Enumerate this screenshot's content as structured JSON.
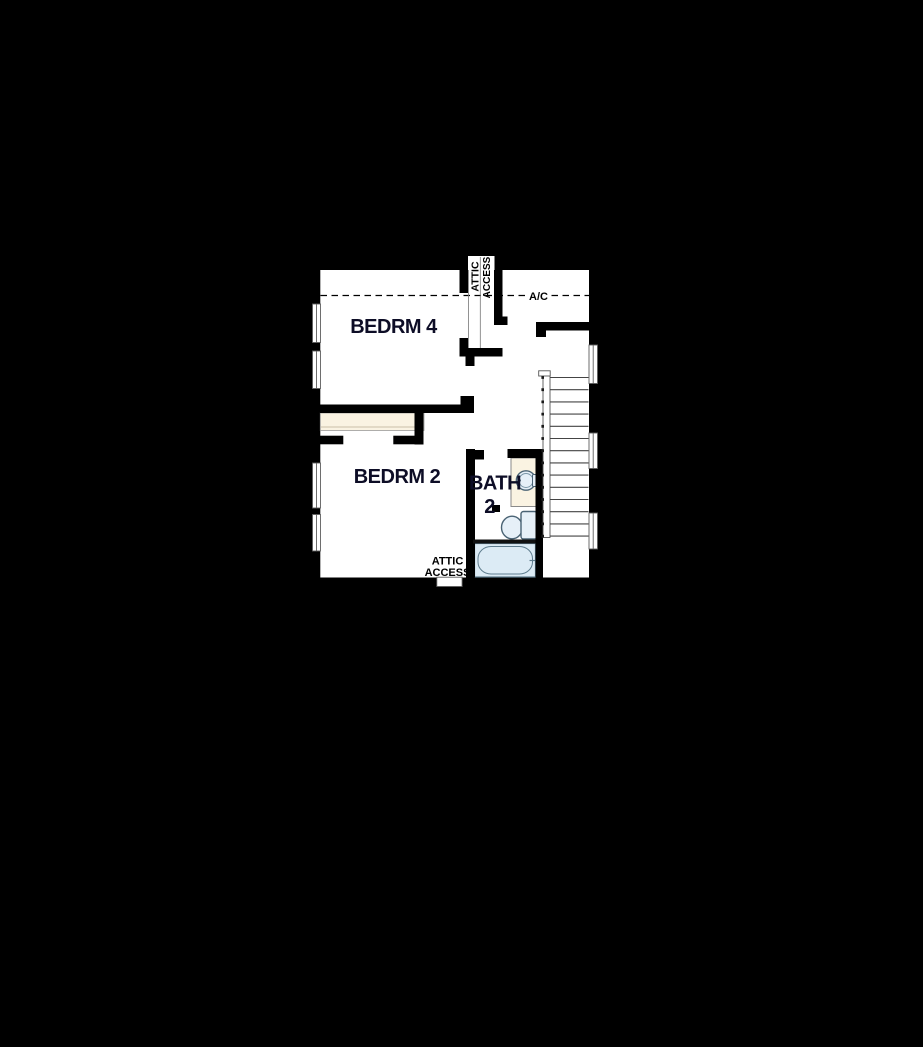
{
  "window": {
    "width": 923,
    "height": 1047,
    "background": "#000000"
  },
  "floor_plan": {
    "type": "residential-second-floor-plan",
    "rooms": {
      "bedroom4": {
        "label": "BEDRM 4"
      },
      "bedroom2": {
        "label": "BEDRM 2"
      },
      "bath2": {
        "label": "BATH",
        "number": "2"
      }
    },
    "annotations": {
      "ac": {
        "label": "A/C"
      },
      "attic_access_top": {
        "line1": "ATTIC",
        "line2": "ACCESS"
      },
      "attic_access_bottom": {
        "line1": "ATTIC",
        "line2": "ACCESS"
      }
    },
    "colors": {
      "background": "#000000",
      "floor": "#ffffff",
      "walls": "#000000",
      "closet_shelf": "#faf3e2",
      "vanity_counter": "#faf3e2",
      "fixture_fill": "#e6f0f8",
      "tub_fill": "#dcebf5",
      "fixture_stroke": "#4a6374",
      "stair_line": "#444444",
      "label_text": "#0d0d26",
      "annotation_text": "#000000"
    }
  }
}
